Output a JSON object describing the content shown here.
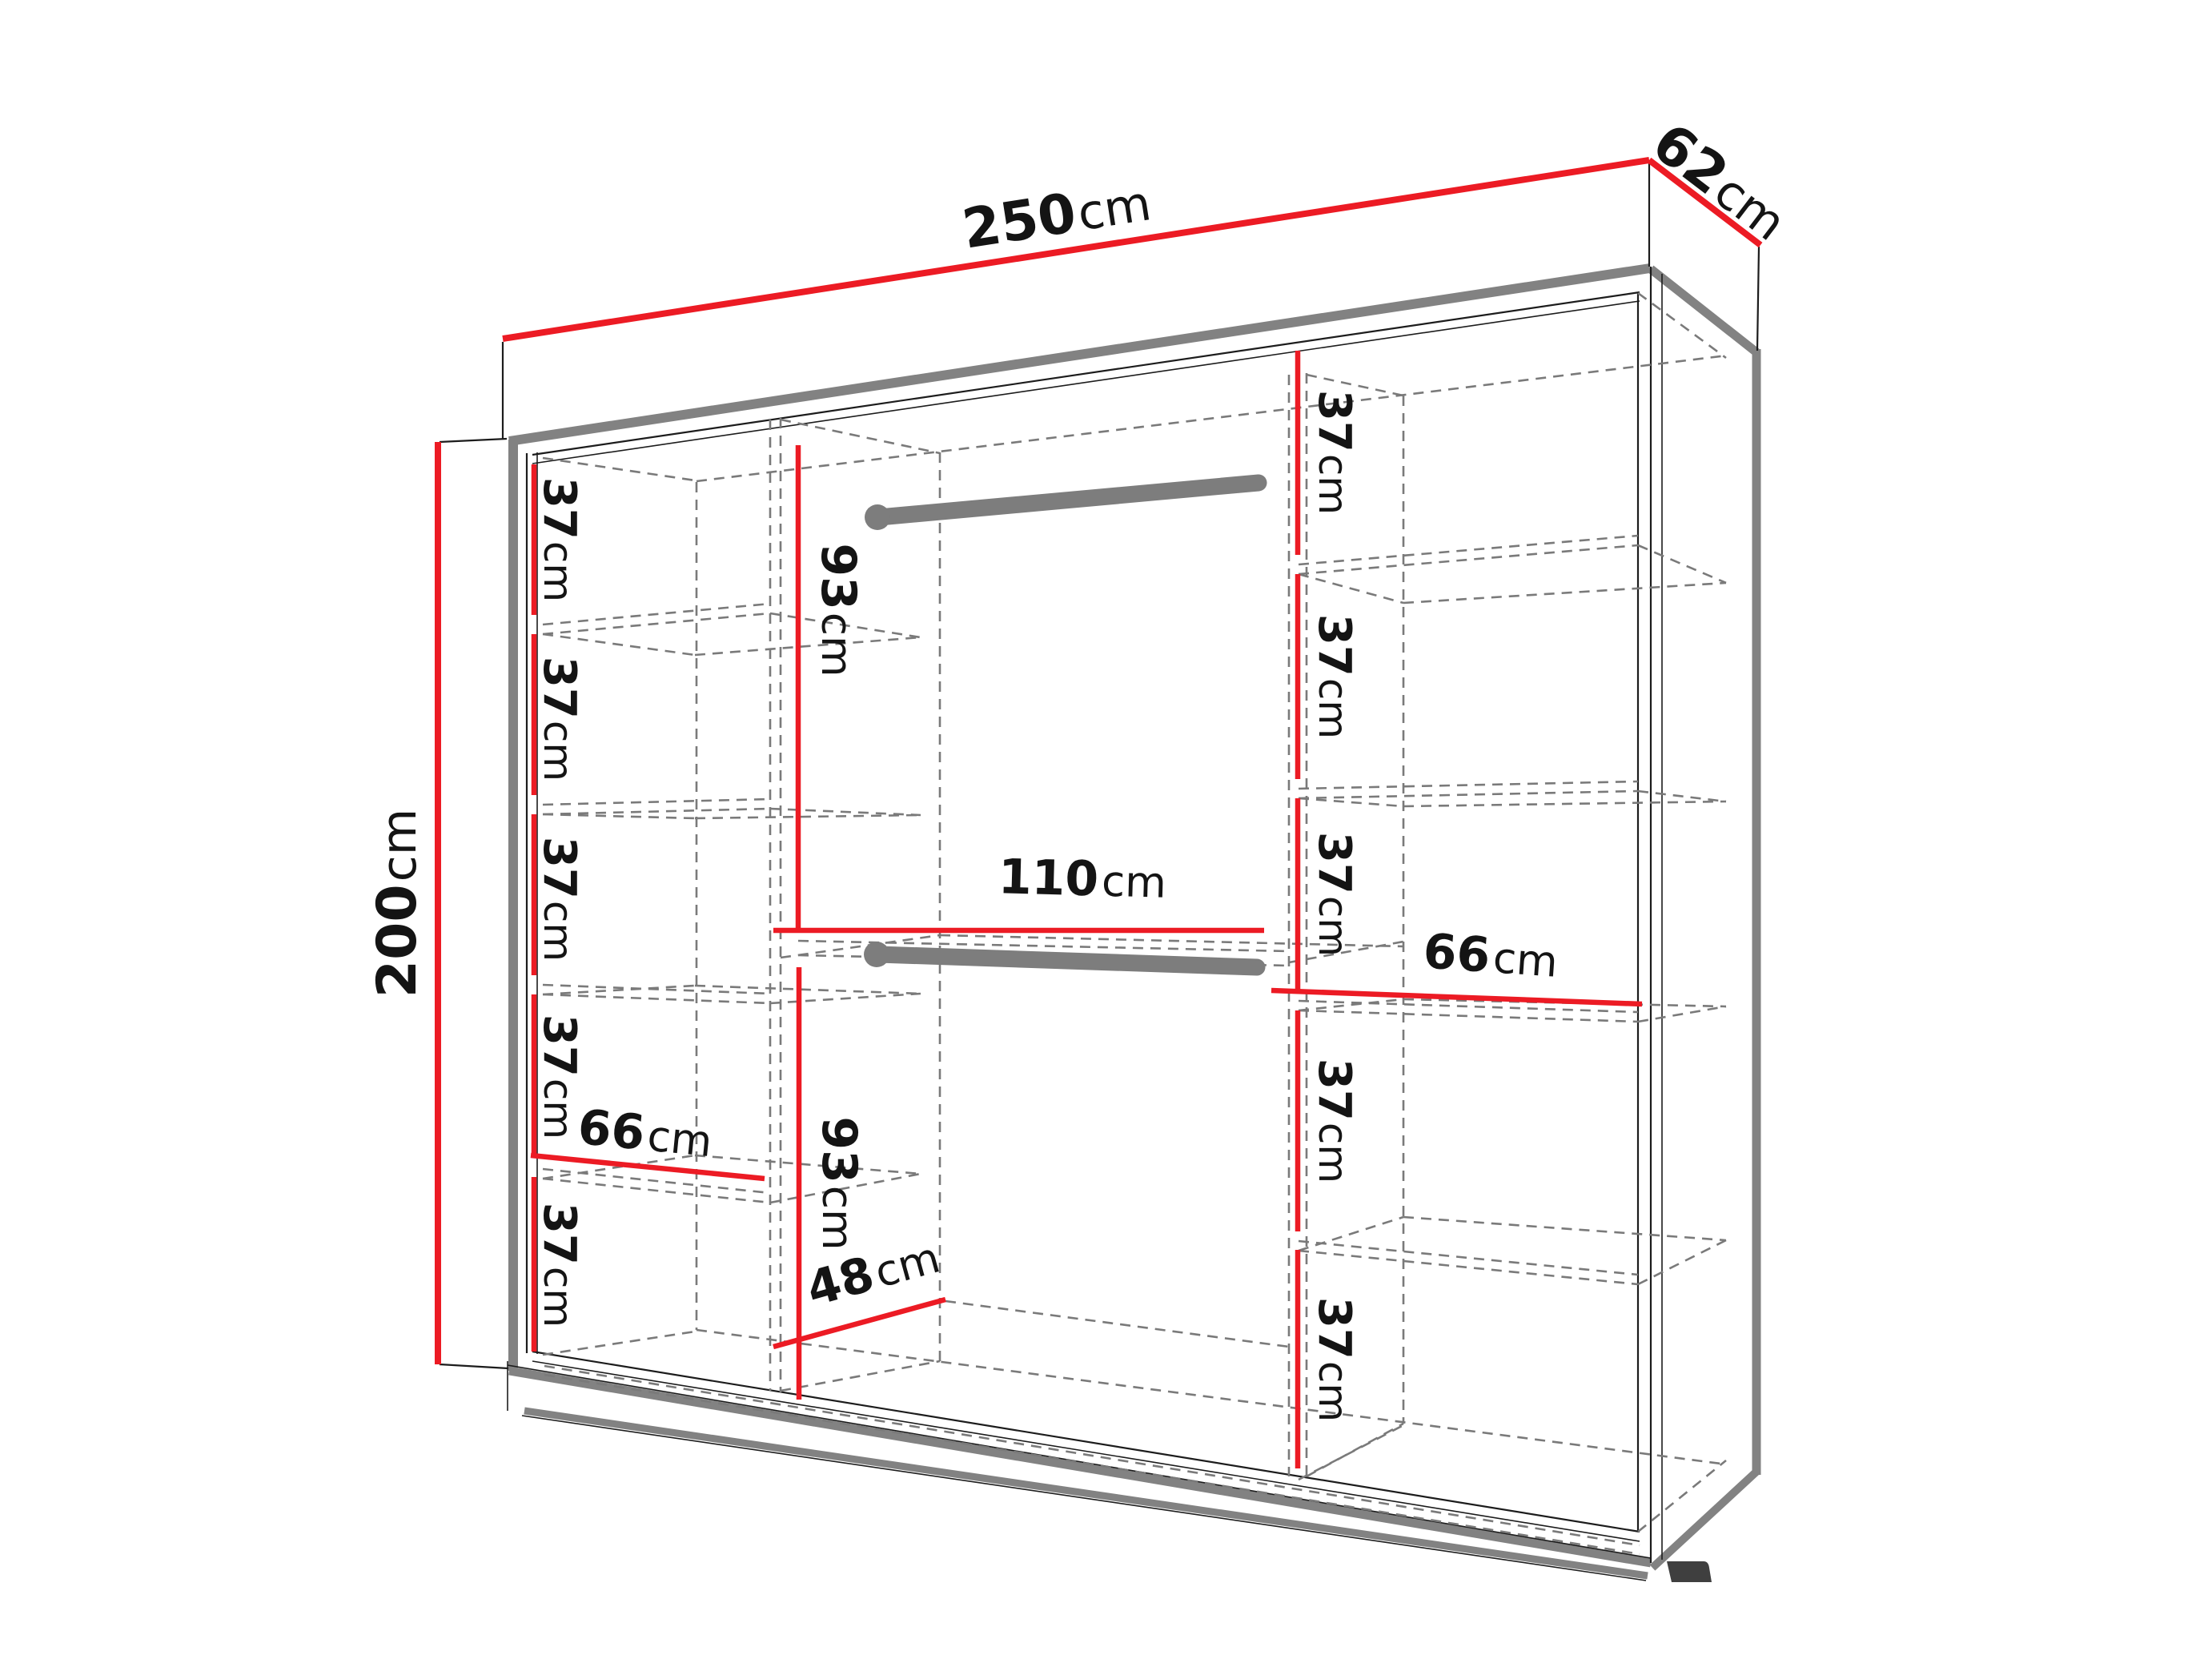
{
  "figure": {
    "kind": "wardrobe interior dimension diagram",
    "view": "perspective line drawing with red dimension lines"
  },
  "colors": {
    "red": "#ec1b24",
    "gray": "#828282",
    "rail": "#7d7d7d",
    "dash": "#7a7a7a",
    "line": "#1c1c1c",
    "text": "#141414",
    "bg": "#ffffff"
  },
  "labels": {
    "width": {
      "value": "250",
      "unit": "cm"
    },
    "depth": {
      "value": "62",
      "unit": "cm"
    },
    "height": {
      "value": "200",
      "unit": "cm"
    },
    "middle_top_height": {
      "value": "93",
      "unit": "cm"
    },
    "middle_bottom_height": {
      "value": "93",
      "unit": "cm"
    },
    "middle_width": {
      "value": "110",
      "unit": "cm"
    },
    "middle_floor_depth": {
      "value": "48",
      "unit": "cm"
    },
    "left_shelf_width": {
      "value": "66",
      "unit": "cm"
    },
    "right_shelf_width": {
      "value": "66",
      "unit": "cm"
    },
    "left_gaps": [
      {
        "value": "37",
        "unit": "cm"
      },
      {
        "value": "37",
        "unit": "cm"
      },
      {
        "value": "37",
        "unit": "cm"
      },
      {
        "value": "37",
        "unit": "cm"
      },
      {
        "value": "37",
        "unit": "cm"
      }
    ],
    "right_gaps": [
      {
        "value": "37",
        "unit": "cm"
      },
      {
        "value": "37",
        "unit": "cm"
      },
      {
        "value": "37",
        "unit": "cm"
      },
      {
        "value": "37",
        "unit": "cm"
      },
      {
        "value": "37",
        "unit": "cm"
      }
    ]
  }
}
